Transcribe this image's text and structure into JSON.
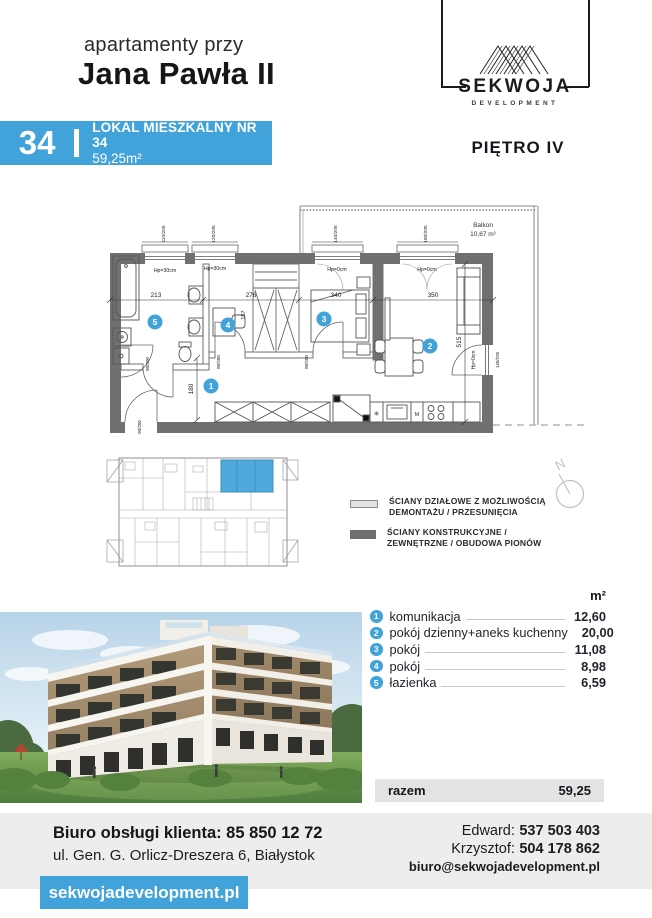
{
  "header": {
    "subtitle": "apartamenty przy",
    "title": "Jana Pawła II",
    "unit_number": "34",
    "unit_label": "LOKAL MIESZKALNY NR 34",
    "unit_area": "59,25m²",
    "floor_label": "PIĘTRO IV"
  },
  "logo": {
    "name": "SEKWOJA",
    "subname": "DEVELOPMENT"
  },
  "colors": {
    "accent": "#41A3D9",
    "wall": "#707070",
    "footer_bg": "#EDEDED",
    "total_bg": "#E3E3E3"
  },
  "floor_plan": {
    "balcony_label": "Balkon",
    "balcony_area": "10,67 m²",
    "dims": [
      "213",
      "276",
      "340",
      "350"
    ],
    "dim_height": "515",
    "dim_corridor": "180",
    "dim_small": "157",
    "window_labels": [
      "110/205",
      "120/205",
      "140/205",
      "180/205"
    ],
    "hp_labels": [
      "Hp=30cm",
      "Hp=30cm",
      "Hp=0cm",
      "Hp=0cm",
      "Hp=0cm"
    ],
    "door_labels": [
      "80/200",
      "80/200",
      "80/200",
      "90/200",
      "140/235"
    ],
    "room_numbers": [
      "1",
      "2",
      "3",
      "4",
      "5"
    ]
  },
  "compass": {
    "label": "N"
  },
  "legend": {
    "item1_line1": "ŚCIANY DZIAŁOWE Z MOŻLIWOŚCIĄ",
    "item1_line2": "DEMONTAŻU / PRZESUNIĘCIA",
    "item2_line1": "ŚCIANY KONSTRUKCYJNE /",
    "item2_line2": "ZEWNĘTRZNE / OBUDOWA PIONÓW"
  },
  "rooms": {
    "header_unit": "m²",
    "items": [
      {
        "num": "1",
        "label": "komunikacja",
        "area": "12,60"
      },
      {
        "num": "2",
        "label": "pokój dzienny+aneks kuchenny",
        "area": "20,00"
      },
      {
        "num": "3",
        "label": "pokój",
        "area": "11,08"
      },
      {
        "num": "4",
        "label": "pokój",
        "area": "8,98"
      },
      {
        "num": "5",
        "label": "łazienka",
        "area": "6,59"
      }
    ],
    "total_label": "razem",
    "total_value": "59,25"
  },
  "footer": {
    "office_label": "Biuro obsługi klienta:",
    "office_phone": "85 850 12 72",
    "address": "ul. Gen. G. Orlicz-Dreszera 6, Białystok",
    "website": "sekwojadevelopment.pl",
    "contact1_name": "Edward:",
    "contact1_phone": "537 503 403",
    "contact2_name": "Krzysztof:",
    "contact2_phone": "504 178 862",
    "email": "biuro@sekwojadevelopment.pl"
  }
}
